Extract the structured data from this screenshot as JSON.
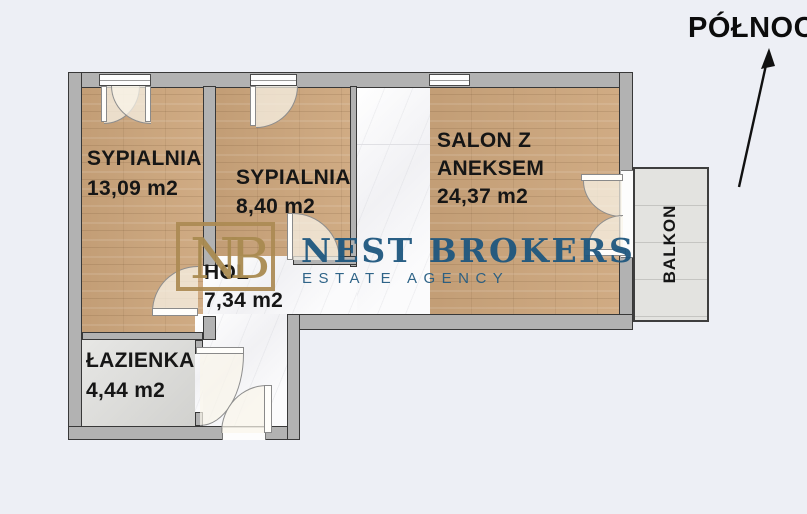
{
  "compass": {
    "label": "PÓŁNOC"
  },
  "brand": {
    "initials": "NB",
    "name": "NEST BROKERS",
    "tagline": "ESTATE AGENCY"
  },
  "rooms": {
    "bedroom1": {
      "name": "SYPIALNIA",
      "area": "13,09 m2"
    },
    "bedroom2": {
      "name": "SYPIALNIA",
      "area": "8,40 m2"
    },
    "living": {
      "name_line1": "SALON Z",
      "name_line2": "ANEKSEM",
      "area": "24,37 m2"
    },
    "hall": {
      "name": "HOL",
      "area": "7,34 m2"
    },
    "bathroom": {
      "name": "ŁAZIENKA",
      "area": "4,44 m2"
    },
    "balcony": {
      "name": "BALKON"
    }
  },
  "colors": {
    "background": "#edeff5",
    "wall_gray": "#b2b2b2",
    "wood": "#cda67c",
    "marble": "#f8f8f9",
    "bathroom_tile": "#dadad7",
    "balcony_gray": "#e3e3e0",
    "label_black": "#161616",
    "brand_navy": "#1e567e",
    "brand_gold": "#ab8a52"
  }
}
